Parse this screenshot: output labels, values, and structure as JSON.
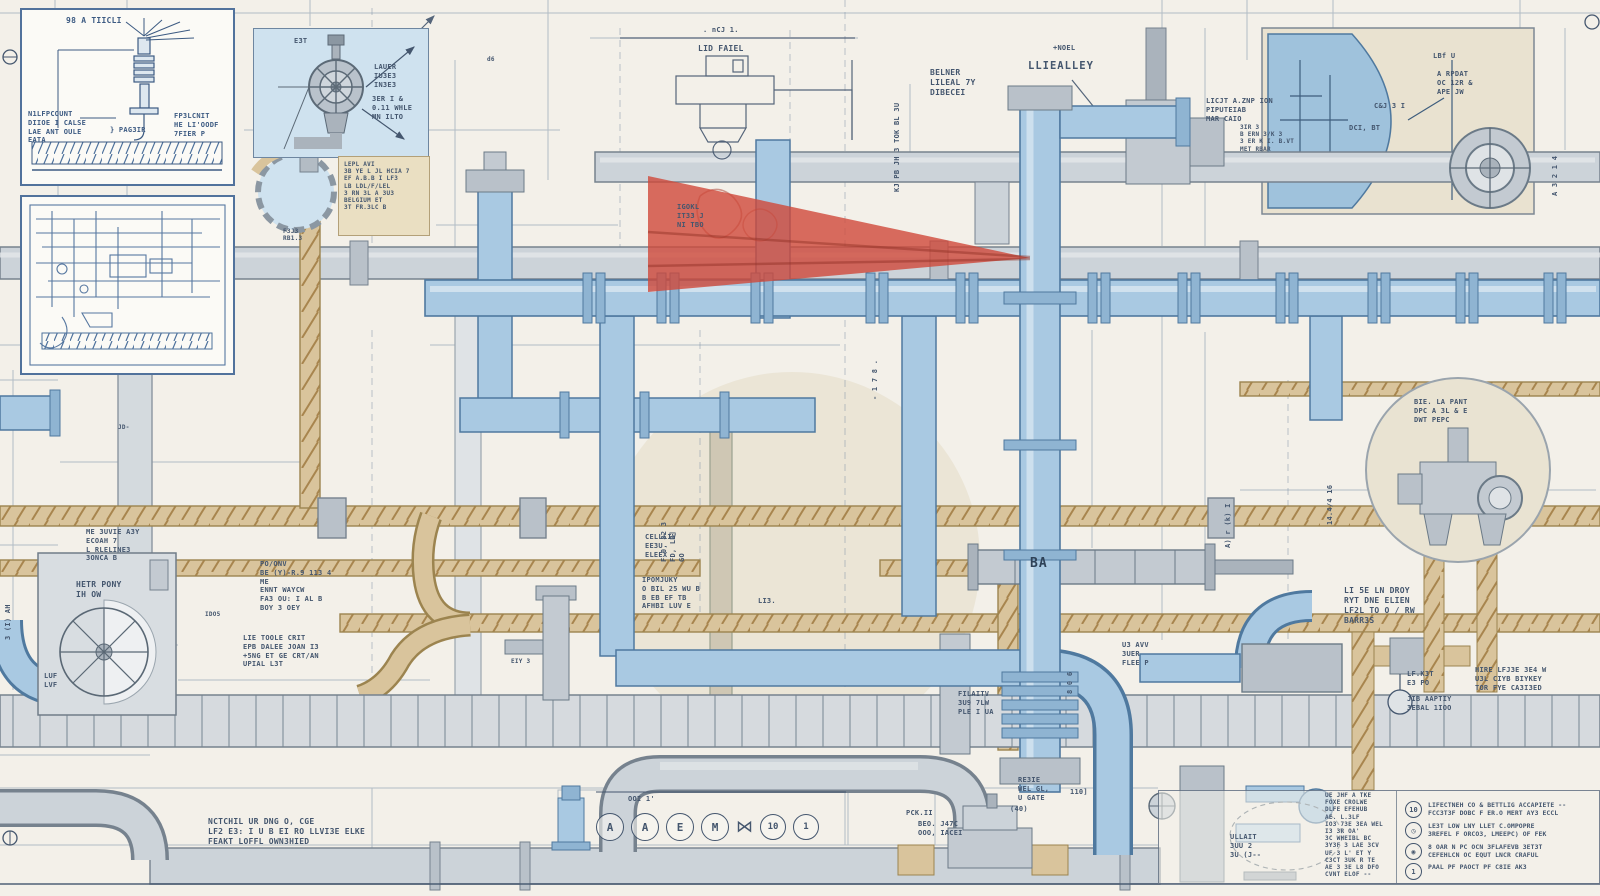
{
  "colors": {
    "paper": "#f3f0e9",
    "ink": "#44566e",
    "pipe_blue": "#a9c9e2",
    "pipe_gray": "#ccd3d9",
    "pipe_tan": "#d9c49c",
    "beige": "#e9e2d0",
    "panel_blue": "#cfe2ef",
    "highlight_red": "#d0493a"
  },
  "inset_detail": {
    "title": "98 A TIICLI",
    "note_left": "N1LFPCOUNT\nDIIOE I CALSE\nLAE ANT OULE\nEATA",
    "note_right": "FP3LCNIT\nHE LI'OODF\n7FIER P",
    "tag": "} PAG3IR"
  },
  "valve_panel": {
    "tag": "E3T",
    "note_a": "LAUER\nIU3E3\nIN3E3",
    "note_b": "3ER I &\n0.11 WHLE\nMN ILTO"
  },
  "tan_note": {
    "text": "LEPL AVI\n3B YE L JL HCIA 7\nEF A.B.B I LF3\nLB LDL/F/LEL\n3 RN 3L A 3U3\nBELGIUM ET\n3T FR.3LC B",
    "footer": "F3J3\nRB1.3"
  },
  "labels": [
    {
      "text": ". nCJ 1."
    },
    {
      "text": "LID FAIEL"
    },
    {
      "text": "+NOEL"
    },
    {
      "text": "BELNER\nLILEAL 7Y\nDIBECEI"
    },
    {
      "text": "LLIEALLEY"
    },
    {
      "text": "KJ PB JH 3  TOK BL 3U"
    },
    {
      "text": "- 1 7 8 ."
    },
    {
      "text": "LBf U"
    },
    {
      "text": "A RPDAT\nOC 12R &\nAPE JW"
    },
    {
      "text": "C&J 3 I"
    },
    {
      "text": "DCI, BT"
    },
    {
      "text": "A 3 2 1 4"
    },
    {
      "text": "LICJT A.ZNP ION\nPIPUTEIAB\nMAR CAIO"
    },
    {
      "text": "3IR 3\nB ERN 3/K 3\n3 ER K I. B.VT\nMET RBAR"
    },
    {
      "text": "IGOKL\nIT33 J\nNI TBO"
    },
    {
      "text": "ME 3UVIE A3Y\nECOAH 7\nL RLELINE3\n3ONCA B"
    },
    {
      "text": "HETR PONY\nIH OW"
    },
    {
      "text": "LUF\nLVF"
    },
    {
      "text": "PO/ONV\nBE (Y)-R.9 113 4\nME\nENNT WAYCW\nFA3 OU: I AL B\nBOY 3 OEY"
    },
    {
      "text": "LIE TOOLE CRIT\nEPB DALEE JOAN I3\n+5NG ET GE CRT/AN\nUPIAL L3T"
    },
    {
      "text": "IDO5"
    },
    {
      "text": "CELLLIV\nEE3U\nELEEX"
    },
    {
      "text": "IPOMJUKY\nO BIL 25 WU B\nB EB EF TB\nAFHBI LUV E"
    },
    {
      "text": "F 0, 82 3\nFD, LB]\nGO"
    },
    {
      "text": "LI3."
    },
    {
      "text": "FILAITV\n3U9 7LW\nPLE I UA"
    },
    {
      "text": "U3 AVV\n3UER\nFLEE P"
    },
    {
      "text": "BA"
    },
    {
      "text": "8 0 6"
    },
    {
      "text": "BIE. LA PANT\nDPC A 3L & E\nDWT PEPC"
    },
    {
      "text": "A) r (k) I"
    },
    {
      "text": "14.4/4 16"
    },
    {
      "text": "NCTCHIL UR DNG O, CGE\nLF2 E3: I U B EI RO LLVI3E ELKE\nFEAKT LOFFL OWN3HIED"
    },
    {
      "text": "LI 5E LN DROY\nRYT DNE ELIEN\nLF2L TO O / RW\nBARR3S"
    },
    {
      "text": "RE3IE\nWEL GL,\nU GATE"
    },
    {
      "text": "BEO. J47C\nOOO, IACEI"
    },
    {
      "text": "(40)"
    },
    {
      "text": "110]"
    },
    {
      "text": "PCK.II"
    },
    {
      "text": "ULLAIT\n3UU 2\n3U (J--"
    },
    {
      "text": "UE JHF A TKE\nFOXE CROLWE\nDLFE EFEHUB\nAE. L.3LF\nIO3 73E 3EA WEL\nI3 3R OA'\n3C WHEIBL BC\n3Y3F 3 LAE 3CV\nUF 3 L' ET Y\nC3CT 3UK R TE\nAE 3 3E L8 DFO\nCVNT ELOF --"
    },
    {
      "text": "LF.K3T\nE3 PO"
    },
    {
      "text": "JIB AAPTIY\n3EBAL 1IOO"
    },
    {
      "text": "HIRE LFJ3E 3E4 W\nU3L CIYB BIYKEY\nTOR FYE CA3I3ED"
    },
    {
      "text": "EIY 3"
    },
    {
      "text": "JD-"
    },
    {
      "text": "d6"
    },
    {
      "text": "3 (I) AH"
    }
  ],
  "tags_row": {
    "dim": "OOI 1'",
    "circles": [
      "A",
      "A",
      "E",
      "M"
    ],
    "valve_icon": "⋈",
    "circles_num": [
      "10",
      "1"
    ]
  },
  "legend": {
    "items": [
      {
        "badge": "10",
        "text": "LIFECTNEH CO & BETTLIG ACCAPIETE --\nFCC3T3F DOBC F ER.O MERT AY3 ECCL"
      },
      {
        "badge": "◷",
        "text": "LE3T LOW LNY LLET C.OMPOPRE\n3REFEL F ORCO3, LMEEPC) OF FEK"
      },
      {
        "badge": "◉",
        "text": "8 OAR N PC OCN 3FLAFEVB 3ET3T\nCEFEHLCN OC EQUT LNCR CRAFUL"
      },
      {
        "badge": "1",
        "text": "PAAL PF PAOCT PF C8IE AK3"
      }
    ]
  }
}
